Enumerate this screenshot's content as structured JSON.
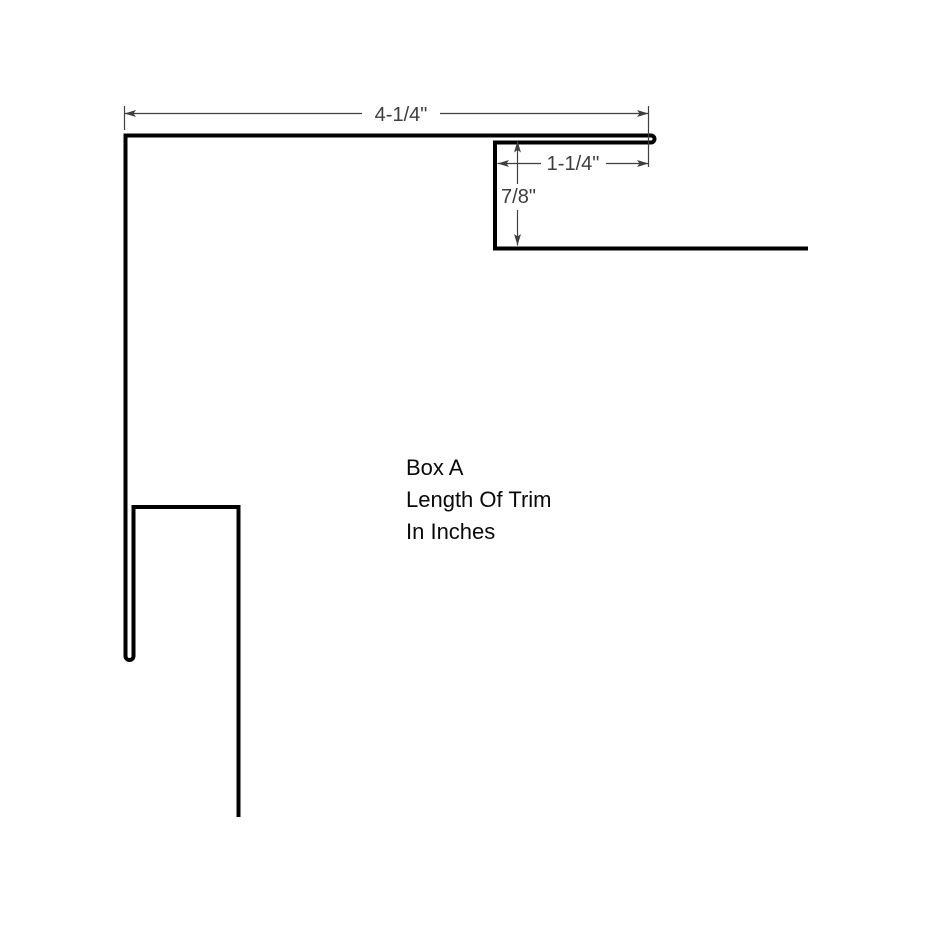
{
  "drawing": {
    "annotation": {
      "line1": "Box A",
      "line2": "Length Of Trim",
      "line3": "In Inches"
    },
    "dimensions": {
      "flange_width": "4-1/4\"",
      "hem_return_width": "1-1/4\"",
      "step_height": "7/8\""
    },
    "colors": {
      "profile": "#000000",
      "dimension": "#3f3f3f",
      "dimension_text": "#3d3d3d",
      "annotation_text": "#0a0a0a",
      "background": "#ffffff"
    }
  }
}
